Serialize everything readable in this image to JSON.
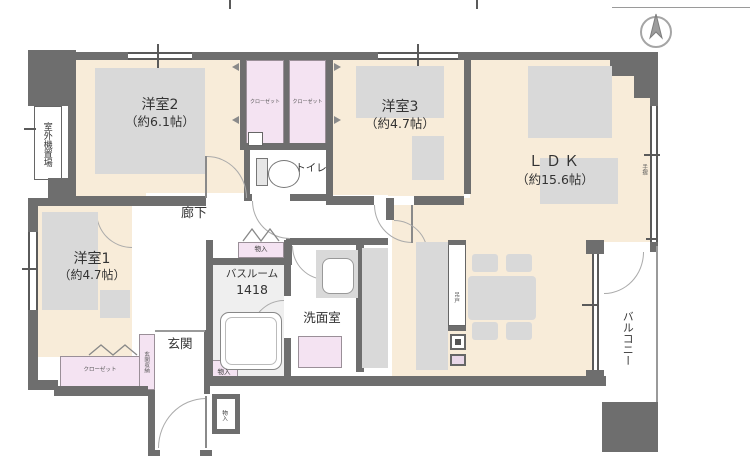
{
  "plan": {
    "title": "apartment-floor-plan",
    "compass": "north-up",
    "rooms": {
      "bedroom2": {
        "name": "洋室2",
        "size": "（約6.1帖）"
      },
      "bedroom3": {
        "name": "洋室3",
        "size": "（約4.7帖）"
      },
      "ldk": {
        "name": "ＬＤＫ",
        "size": "（約15.6帖）"
      },
      "bedroom1": {
        "name": "洋室1",
        "size": "（約4.7帖）"
      },
      "hallway": {
        "name": "廊下"
      },
      "toilet": {
        "name": "トイレ"
      },
      "bathroom": {
        "name": "バスルーム",
        "size": "1418"
      },
      "washroom": {
        "name": "洗面室"
      },
      "entrance": {
        "name": "玄関"
      },
      "balcony": {
        "name": "バルコニー"
      },
      "outdoor_unit": {
        "name": "室外機置場"
      }
    },
    "storage": {
      "closet_a": "クローゼット",
      "closet_b": "クローゼット",
      "closet_bedroom1": "クローゼット",
      "entrance_storage": "玄関収納",
      "storage_hall": "物入",
      "storage_entrance": "物入",
      "storage_outside": "物入"
    },
    "annotations": {
      "handrail": "手摺",
      "hanging_cabinet": "吊戸"
    },
    "colors": {
      "wall": "#6e6e6e",
      "floor": "#f8ecd9",
      "closet": "#f4e3f2",
      "furniture": "#d9d9d9",
      "bath_floor": "#efefef"
    }
  }
}
